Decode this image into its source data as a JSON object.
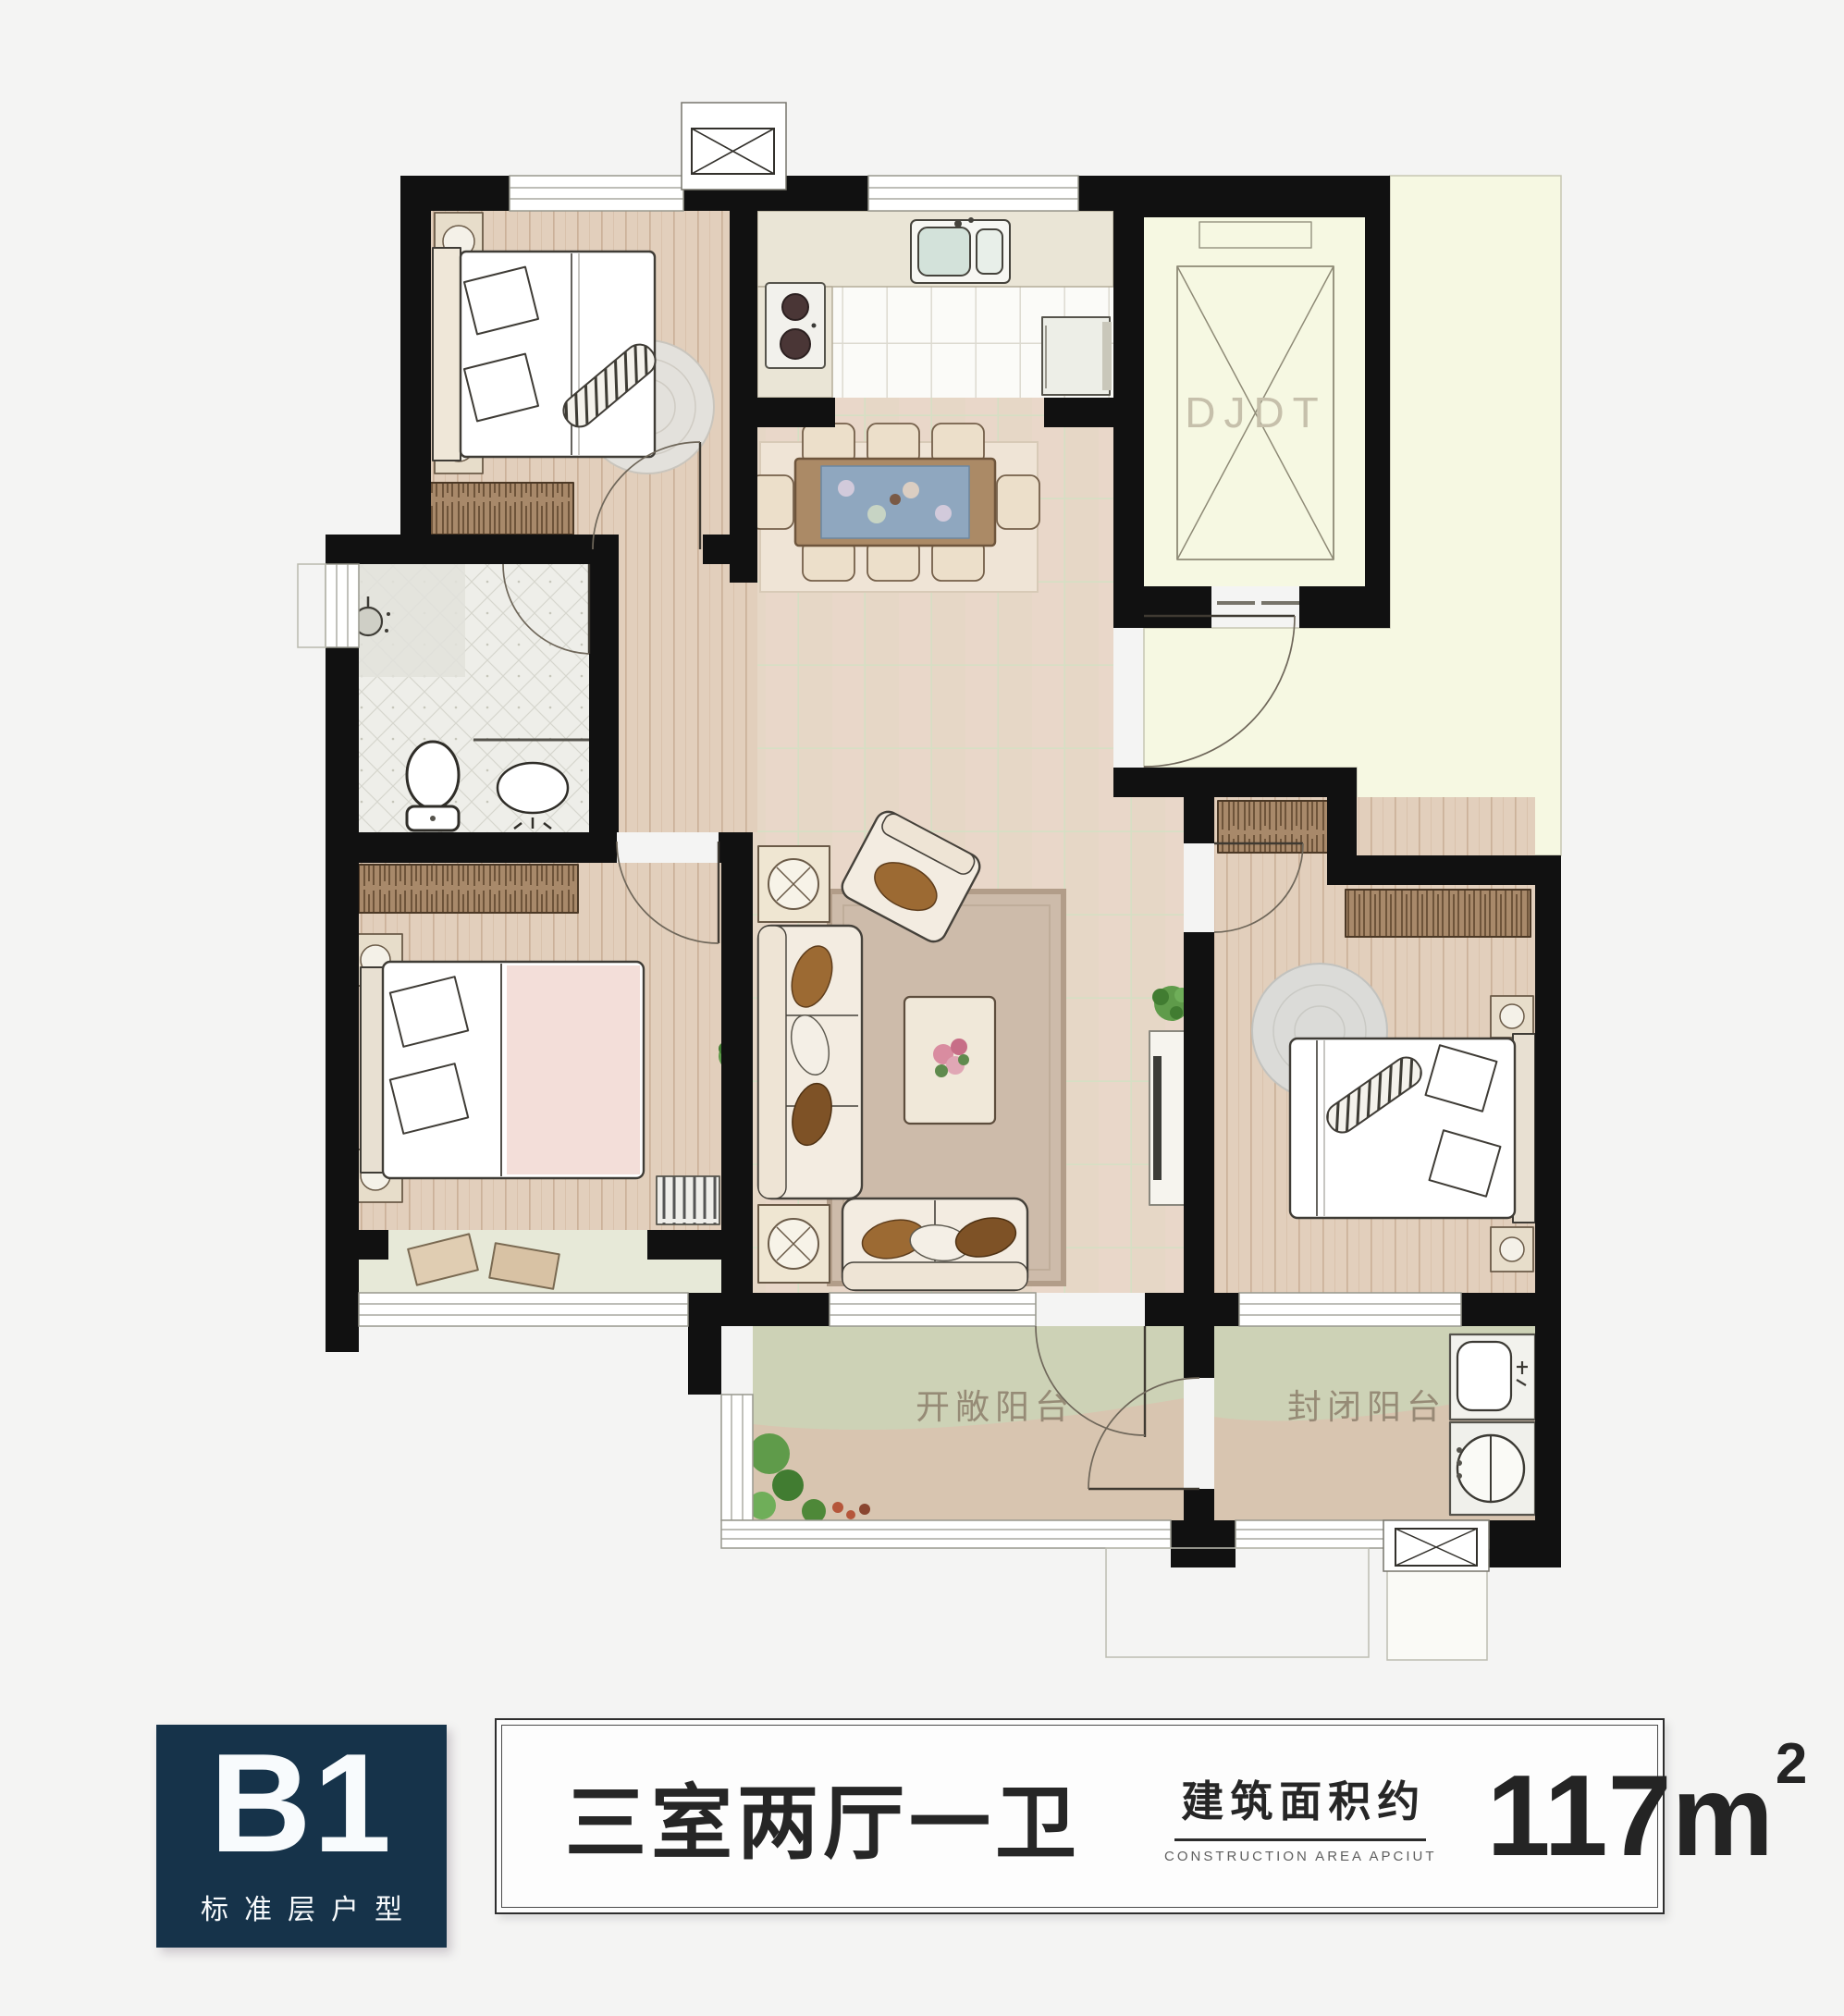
{
  "plan": {
    "elevator_label": "DJDT",
    "open_balcony_label": "开敞阳台",
    "enclosed_balcony_label": "封闭阳台"
  },
  "badge": {
    "code": "B1",
    "subtitle": "标准层户型"
  },
  "info": {
    "layout": "三室两厅一卫",
    "area_label_cn": "建筑面积约",
    "area_label_en": "CONSTRUCTION AREA APCIUT",
    "area_value": "117",
    "area_unit": "m",
    "area_sup": "2"
  },
  "colors": {
    "badge_bg": "#16334a",
    "wall": "#111111",
    "corridor_yellow": "#f6f8e2",
    "wood_floor": "#e2cfbc",
    "living_tile": "#e9d7c9",
    "balcony_green": "#cdd2b6",
    "balcony_sand": "#d8c5b0",
    "label_text": "#8d7f6c"
  }
}
